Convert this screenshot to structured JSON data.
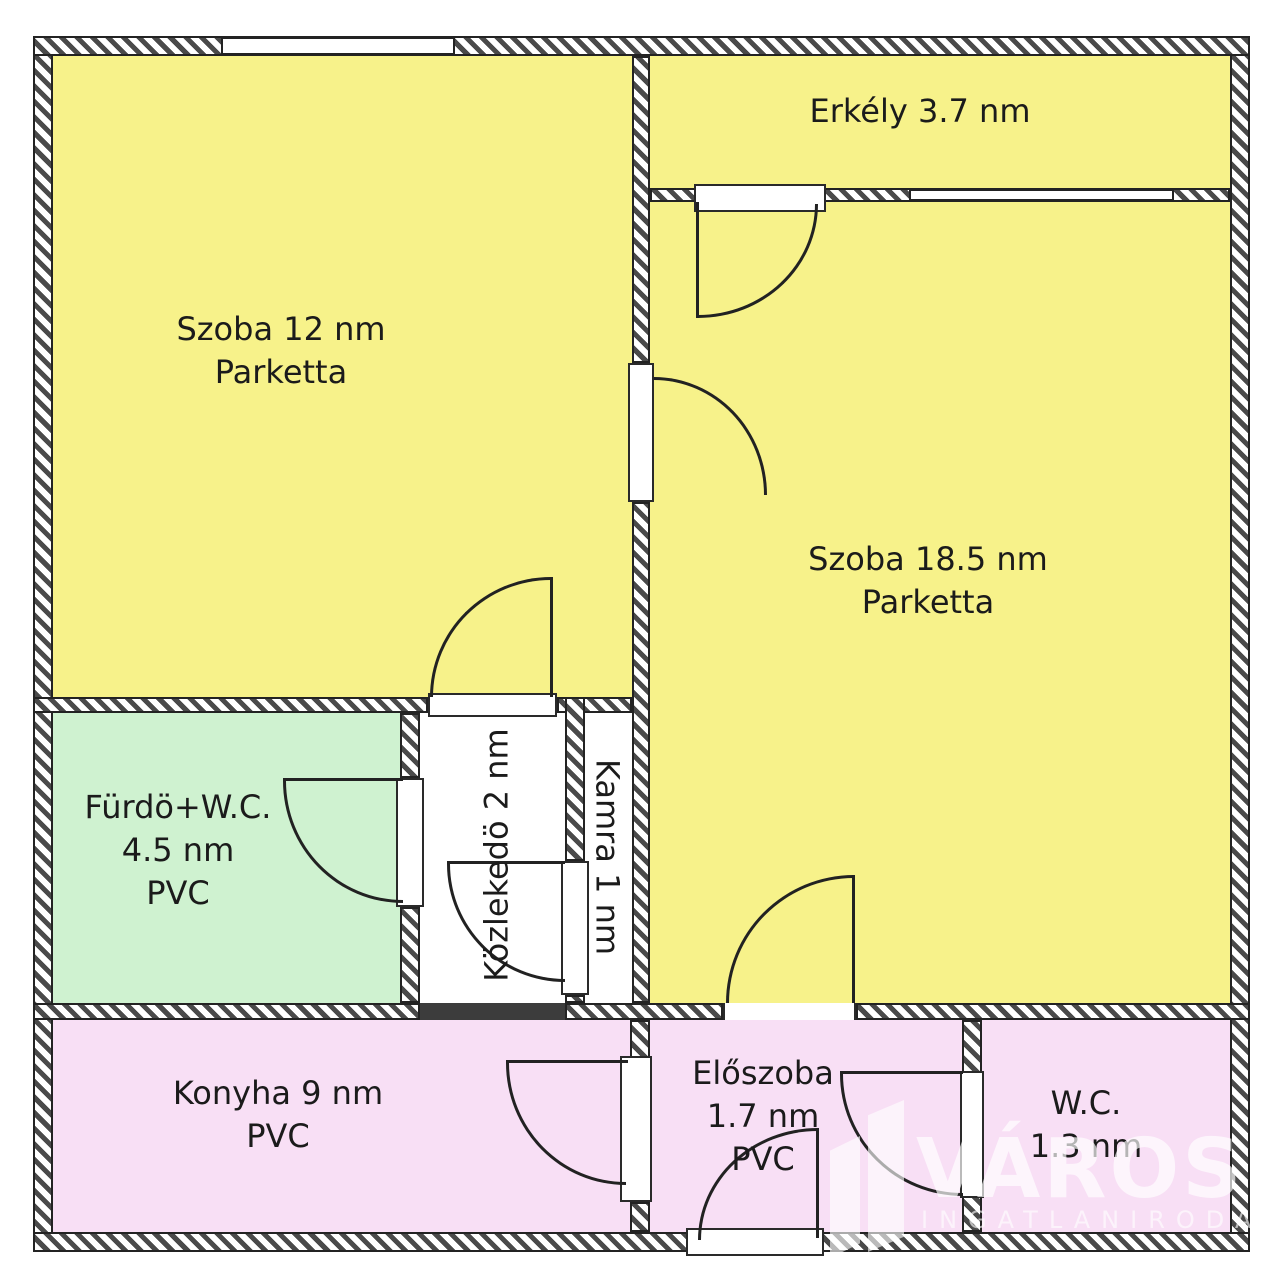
{
  "plan": {
    "rooms": {
      "szoba12": {
        "label": "Szoba 12 nm",
        "floor": "Parketta"
      },
      "erkely": {
        "label": "Erkély 3.7 nm"
      },
      "szoba18": {
        "label": "Szoba 18.5 nm",
        "floor": "Parketta"
      },
      "furdo": {
        "label": "Fürdö+W.C.",
        "area": "4.5 nm",
        "floor": "PVC"
      },
      "kozlekedo": {
        "label": "Közlekedö 2 nm"
      },
      "kamra": {
        "label": "Kamra 1 nm"
      },
      "konyha": {
        "label": "Konyha 9 nm",
        "floor": "PVC"
      },
      "eloszoba": {
        "label": "Előszoba",
        "area": "1.7 nm",
        "floor": "PVC"
      },
      "wc": {
        "label": "W.C.",
        "area": "1.3 nm"
      }
    },
    "watermark": {
      "title": "VÁROSI",
      "subtitle": "INGATLANIRODA"
    },
    "colors": {
      "room_yellow": "#F7F28A",
      "room_green": "#CFF2D0",
      "room_pink": "#F8DFF5",
      "room_white": "#FFFFFF",
      "wall_line": "#232323"
    }
  }
}
